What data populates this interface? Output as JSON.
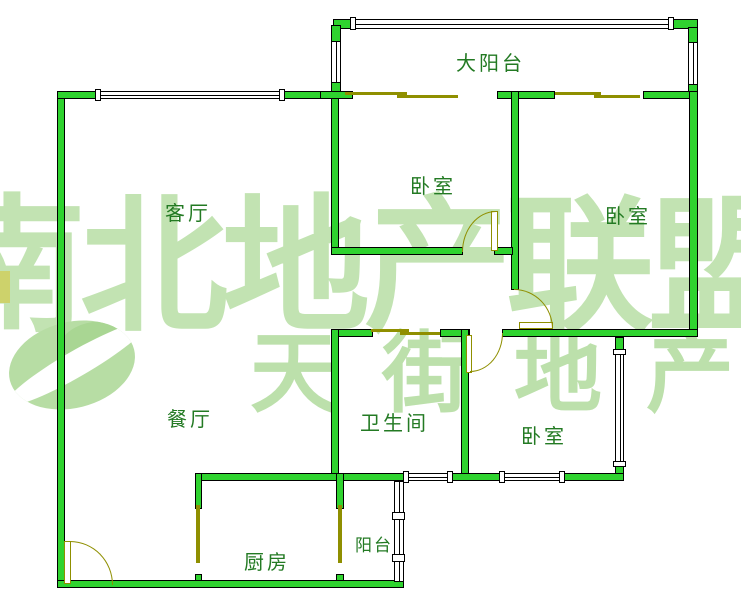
{
  "rooms": {
    "large_balcony": "大阳台",
    "bedroom_top": "卧室",
    "bedroom_right": "卧室",
    "bedroom_lower": "卧室",
    "living_room": "客厅",
    "dining_room": "餐厅",
    "bathroom": "卫生间",
    "kitchen": "厨房",
    "balcony": "阳台"
  },
  "watermark": {
    "line1": "南北地产联盟",
    "line2": "天街地产",
    "logo": "swoosh-ellipse-logo"
  },
  "colors": {
    "wall_fill": "#2fd32f",
    "wall_outline": "#000000",
    "door_line": "#8f8f00",
    "label_text": "#237a23",
    "watermark_green": "#c2e3b2",
    "watermark_yellow": "#cdd26b",
    "background": "#ffffff"
  }
}
